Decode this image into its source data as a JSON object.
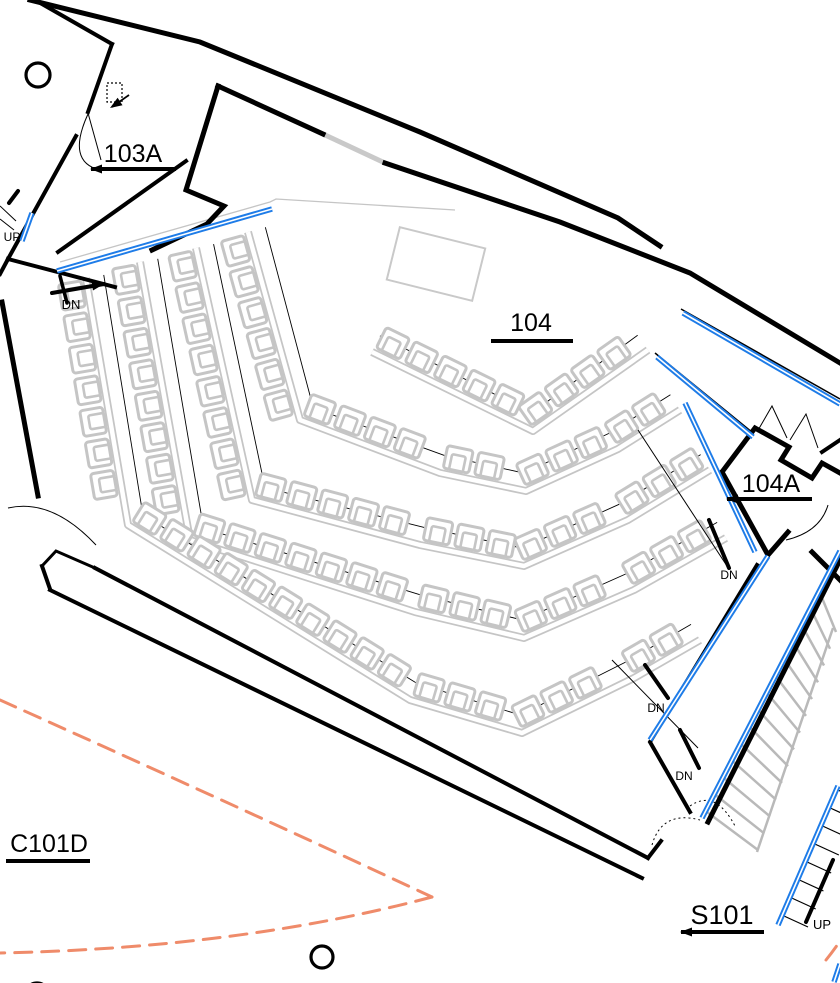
{
  "palette": {
    "wall_black": "#000000",
    "egress_blue": "#1e7ce8",
    "seat_gray": "#c5c5c5",
    "stair_gray": "#b9b9b9",
    "window_gray": "#c9c9c9",
    "exit_path_orange": "#ef8b6a",
    "background": "#ffffff"
  },
  "labels": {
    "rooms": [
      {
        "id": "103A",
        "text": "103A",
        "x": 133,
        "y": 162,
        "size": 25,
        "ul": [
          91,
          176,
          169
        ],
        "arrow": true
      },
      {
        "id": "104",
        "text": "104",
        "x": 531,
        "y": 331,
        "size": 25,
        "ul": [
          491,
          573,
          341
        ],
        "arrow": false
      },
      {
        "id": "104A",
        "text": "104A",
        "x": 771,
        "y": 492,
        "size": 25,
        "ul": [
          727,
          812,
          499
        ],
        "arrow": true
      },
      {
        "id": "C101D",
        "text": "C101D",
        "x": 49,
        "y": 852,
        "size": 25,
        "ul": [
          6,
          90,
          861
        ],
        "arrow": false
      },
      {
        "id": "S101",
        "text": "S101",
        "x": 722,
        "y": 924,
        "size": 27,
        "ul": [
          681,
          764,
          932
        ],
        "arrow": true
      }
    ],
    "small": [
      {
        "id": "up-left",
        "text": "UP",
        "x": 12,
        "y": 241,
        "size": 12
      },
      {
        "id": "dn-seating",
        "text": "DN",
        "x": 71,
        "y": 309,
        "size": 13
      },
      {
        "id": "dn-mid",
        "text": "DN",
        "x": 729,
        "y": 579,
        "size": 12
      },
      {
        "id": "dn-stair-1",
        "text": "DN",
        "x": 656,
        "y": 712,
        "size": 12
      },
      {
        "id": "dn-stair-2",
        "text": "DN",
        "x": 684,
        "y": 780,
        "size": 12
      },
      {
        "id": "up-stair",
        "text": "UP",
        "x": 822,
        "y": 929,
        "size": 13
      }
    ]
  },
  "geometry": {
    "walls": [
      {
        "pts": [
          [
            30,
            0
          ],
          [
            200,
            42
          ],
          [
            420,
            132
          ],
          [
            618,
            218
          ],
          [
            660,
            246
          ]
        ],
        "w": 5
      },
      {
        "pts": [
          [
            218,
            86
          ],
          [
            323,
            134
          ]
        ],
        "w": 5
      },
      {
        "pts": [
          [
            385,
            163
          ],
          [
            560,
            222
          ],
          [
            690,
            273
          ],
          [
            840,
            363
          ]
        ],
        "w": 5
      },
      {
        "pts": [
          [
            35,
            0
          ],
          [
            112,
            44
          ]
        ],
        "w": 4
      },
      {
        "pts": [
          [
            112,
            44
          ],
          [
            88,
            112
          ]
        ],
        "w": 4
      },
      {
        "pts": [
          [
            218,
            86
          ],
          [
            186,
            190
          ],
          [
            224,
            206
          ],
          [
            207,
            224
          ],
          [
            152,
            250
          ]
        ],
        "w": 5
      },
      {
        "pts": [
          [
            186,
            161
          ],
          [
            58,
            252
          ]
        ],
        "w": 4
      },
      {
        "pts": [
          [
            76,
            136
          ],
          [
            8,
            259
          ]
        ],
        "w": 4
      },
      {
        "pts": [
          [
            8,
            259
          ],
          [
            0,
            274
          ]
        ],
        "w": 4
      },
      {
        "pts": [
          [
            8,
            259
          ],
          [
            115,
            287
          ]
        ],
        "w": 4
      },
      {
        "pts": [
          [
            2,
            302
          ],
          [
            38,
            496
          ]
        ],
        "w": 5
      },
      {
        "pts": [
          [
            42,
            566
          ],
          [
            56,
            551
          ],
          [
            95,
            568
          ]
        ],
        "w": 3
      },
      {
        "pts": [
          [
            50,
            589
          ],
          [
            42,
            566
          ]
        ],
        "w": 4
      },
      {
        "pts": [
          [
            95,
            568
          ],
          [
            648,
            858
          ]
        ],
        "w": 4
      },
      {
        "pts": [
          [
            50,
            590
          ],
          [
            642,
            878
          ]
        ],
        "w": 4
      },
      {
        "pts": [
          [
            648,
            858
          ],
          [
            661,
            841
          ]
        ],
        "w": 4
      },
      {
        "pts": [
          [
            757,
            565
          ],
          [
            650,
            742
          ],
          [
            690,
            812
          ]
        ],
        "w": 4
      },
      {
        "pts": [
          [
            840,
            560
          ],
          [
            708,
            822
          ]
        ],
        "w": 5
      },
      {
        "pts": [
          [
            722,
            472
          ],
          [
            755,
            428
          ],
          [
            789,
            447
          ],
          [
            781,
            460
          ],
          [
            812,
            478
          ],
          [
            822,
            463
          ],
          [
            840,
            473
          ]
        ],
        "w": 5
      },
      {
        "pts": [
          [
            722,
            472
          ],
          [
            768,
            555
          ],
          [
            788,
            532
          ]
        ],
        "w": 5
      },
      {
        "pts": [
          [
            812,
            552
          ],
          [
            840,
            580
          ]
        ],
        "w": 5
      },
      {
        "pts": [
          [
            840,
            440
          ],
          [
            822,
            452
          ]
        ],
        "w": 4
      }
    ],
    "blue_lines": [
      {
        "pts": [
          [
            57,
            271
          ],
          [
            272,
            209
          ]
        ]
      },
      {
        "pts": [
          [
            32,
            213
          ],
          [
            22,
            241
          ]
        ]
      },
      {
        "pts": [
          [
            683,
            313
          ],
          [
            840,
            404
          ]
        ]
      },
      {
        "pts": [
          [
            657,
            357
          ],
          [
            753,
            437
          ]
        ]
      },
      {
        "pts": [
          [
            685,
            403
          ],
          [
            755,
            552
          ]
        ]
      },
      {
        "pts": [
          [
            768,
            556
          ],
          [
            650,
            740
          ]
        ]
      },
      {
        "pts": [
          [
            840,
            551
          ],
          [
            702,
            818
          ]
        ]
      },
      {
        "pts": [
          [
            838,
            786
          ],
          [
            778,
            925
          ]
        ]
      },
      {
        "pts": [
          [
            834,
            982
          ],
          [
            840,
            964
          ]
        ]
      }
    ],
    "thin_lines": [
      {
        "pts": [
          [
            0,
            206
          ],
          [
            16,
            221
          ]
        ],
        "w": 1
      },
      {
        "pts": [
          [
            0,
            219
          ],
          [
            14,
            230
          ]
        ],
        "w": 1
      },
      {
        "pts": [
          [
            88,
            113
          ],
          [
            101,
            160
          ]
        ],
        "w": 1
      },
      {
        "pts": [
          [
            638,
            430
          ],
          [
            727,
            566
          ]
        ],
        "w": 1
      },
      {
        "pts": [
          [
            612,
            660
          ],
          [
            698,
            748
          ]
        ],
        "w": 1
      },
      {
        "pts": [
          [
            681,
            309
          ],
          [
            840,
            399
          ]
        ],
        "w": 1.5
      },
      {
        "pts": [
          [
            655,
            353
          ],
          [
            753,
            433
          ]
        ],
        "w": 1.5
      },
      {
        "pts": [
          [
            757,
            432
          ],
          [
            772,
            406
          ],
          [
            787,
            438
          ]
        ],
        "w": 1
      },
      {
        "pts": [
          [
            790,
            440
          ],
          [
            806,
            414
          ],
          [
            818,
            448
          ]
        ],
        "w": 1
      }
    ],
    "gray_lines": [
      {
        "pts": [
          [
            323,
            134
          ],
          [
            385,
            163
          ]
        ],
        "w": 5,
        "color": "window_gray"
      },
      {
        "pts": [
          [
            60,
            262
          ],
          [
            270,
            202
          ],
          [
            276,
            199
          ],
          [
            455,
            210
          ]
        ],
        "w": 1.3,
        "color": "seat_gray"
      },
      {
        "pts": [
          [
            757,
            852
          ],
          [
            833,
            628
          ]
        ],
        "w": 2.5,
        "color": "stair_gray"
      }
    ],
    "door_arcs": [
      {
        "d": "M88,114 Q66,162 100,170",
        "dash": ""
      },
      {
        "d": "M8,508 Q52,498 96,545",
        "dash": ""
      },
      {
        "d": "M786,540 Q820,532 828,505",
        "dash": ""
      },
      {
        "d": "M652,845 Q662,810 700,820",
        "dash": "2 3"
      },
      {
        "d": "M690,806 Q716,788 736,828",
        "dash": "2 3"
      }
    ],
    "exit_arcs": [
      {
        "d": "M0,700 Q250,812 432,897"
      },
      {
        "d": "M432,897 Q240,948 0,953"
      },
      {
        "d": "M826,960 Q834,950 840,941"
      }
    ],
    "circles": [
      {
        "cx": 38,
        "cy": 75,
        "r": 12
      },
      {
        "cx": 322,
        "cy": 957,
        "r": 11
      },
      {
        "cx": 37,
        "cy": 995,
        "r": 12
      }
    ],
    "stage": {
      "cx": 436,
      "cy": 264,
      "w": 88,
      "h": 54,
      "rot": 14
    },
    "door_icon": {
      "x": 107,
      "y": 83,
      "w": 15,
      "h": 19,
      "arrow": [
        [
          129,
          95
        ],
        [
          112,
          107
        ]
      ]
    },
    "ticks": [
      {
        "pts": [
          [
            9,
            203
          ],
          [
            18,
            191
          ]
        ],
        "w": 4
      },
      {
        "pts": [
          [
            52,
            293
          ],
          [
            104,
            284
          ]
        ],
        "w": 4
      },
      {
        "pts": [
          [
            60,
            276
          ],
          [
            67,
            303
          ]
        ],
        "w": 3.5
      },
      {
        "pts": [
          [
            709,
            520
          ],
          [
            729,
            568
          ]
        ],
        "w": 4
      },
      {
        "pts": [
          [
            645,
            665
          ],
          [
            668,
            698
          ]
        ],
        "w": 4
      },
      {
        "pts": [
          [
            680,
            730
          ],
          [
            699,
            768
          ]
        ],
        "w": 4
      },
      {
        "pts": [
          [
            833,
            860
          ],
          [
            806,
            922
          ]
        ],
        "w": 4
      }
    ],
    "arrows": [
      {
        "x": 104,
        "y": 284,
        "a": -10
      },
      {
        "x": 110,
        "y": 108,
        "a": 147
      }
    ],
    "seat_rows": [
      {
        "pts": [
          [
            372,
            352
          ],
          [
            533,
            431
          ],
          [
            648,
            350
          ]
        ],
        "sides": [
          1,
          1
        ]
      },
      {
        "pts": [
          [
            248,
            232
          ],
          [
            300,
            420
          ],
          [
            440,
            473
          ],
          [
            526,
            491
          ],
          [
            618,
            449
          ],
          [
            680,
            410
          ]
        ],
        "sides": [
          -1,
          1,
          1,
          1,
          1
        ]
      },
      {
        "pts": [
          [
            196,
            248
          ],
          [
            252,
            500
          ],
          [
            420,
            545
          ],
          [
            524,
            566
          ],
          [
            628,
            520
          ],
          [
            710,
            470
          ]
        ],
        "sides": [
          -1,
          1,
          1,
          1,
          1
        ]
      },
      {
        "pts": [
          [
            140,
            262
          ],
          [
            190,
            540
          ],
          [
            415,
            612
          ],
          [
            524,
            638
          ],
          [
            634,
            590
          ],
          [
            726,
            538
          ]
        ],
        "sides": [
          -1,
          1,
          1,
          1,
          1
        ]
      },
      {
        "pts": [
          [
            86,
            278
          ],
          [
            128,
            525
          ],
          [
            410,
            700
          ],
          [
            522,
            733
          ],
          [
            634,
            678
          ],
          [
            700,
            640
          ]
        ],
        "sides": [
          -1,
          1,
          1,
          1,
          1
        ]
      }
    ],
    "chair": {
      "spacing": 32,
      "margin": 15,
      "offset": 17,
      "outer": [
        26,
        23
      ],
      "inner": [
        14,
        16
      ]
    },
    "stairs": {
      "main": {
        "n": 14,
        "a1": [
          707,
          812
        ],
        "a2": [
          820,
          593
        ],
        "b1": [
          758,
          850
        ],
        "b2": [
          836,
          632
        ],
        "w": 2.5
      },
      "lower": {
        "n": 8,
        "p1": [
          784,
          916
        ],
        "p2": [
          838,
          790
        ],
        "d": [
          24,
          11
        ],
        "w": 1.2
      }
    }
  }
}
